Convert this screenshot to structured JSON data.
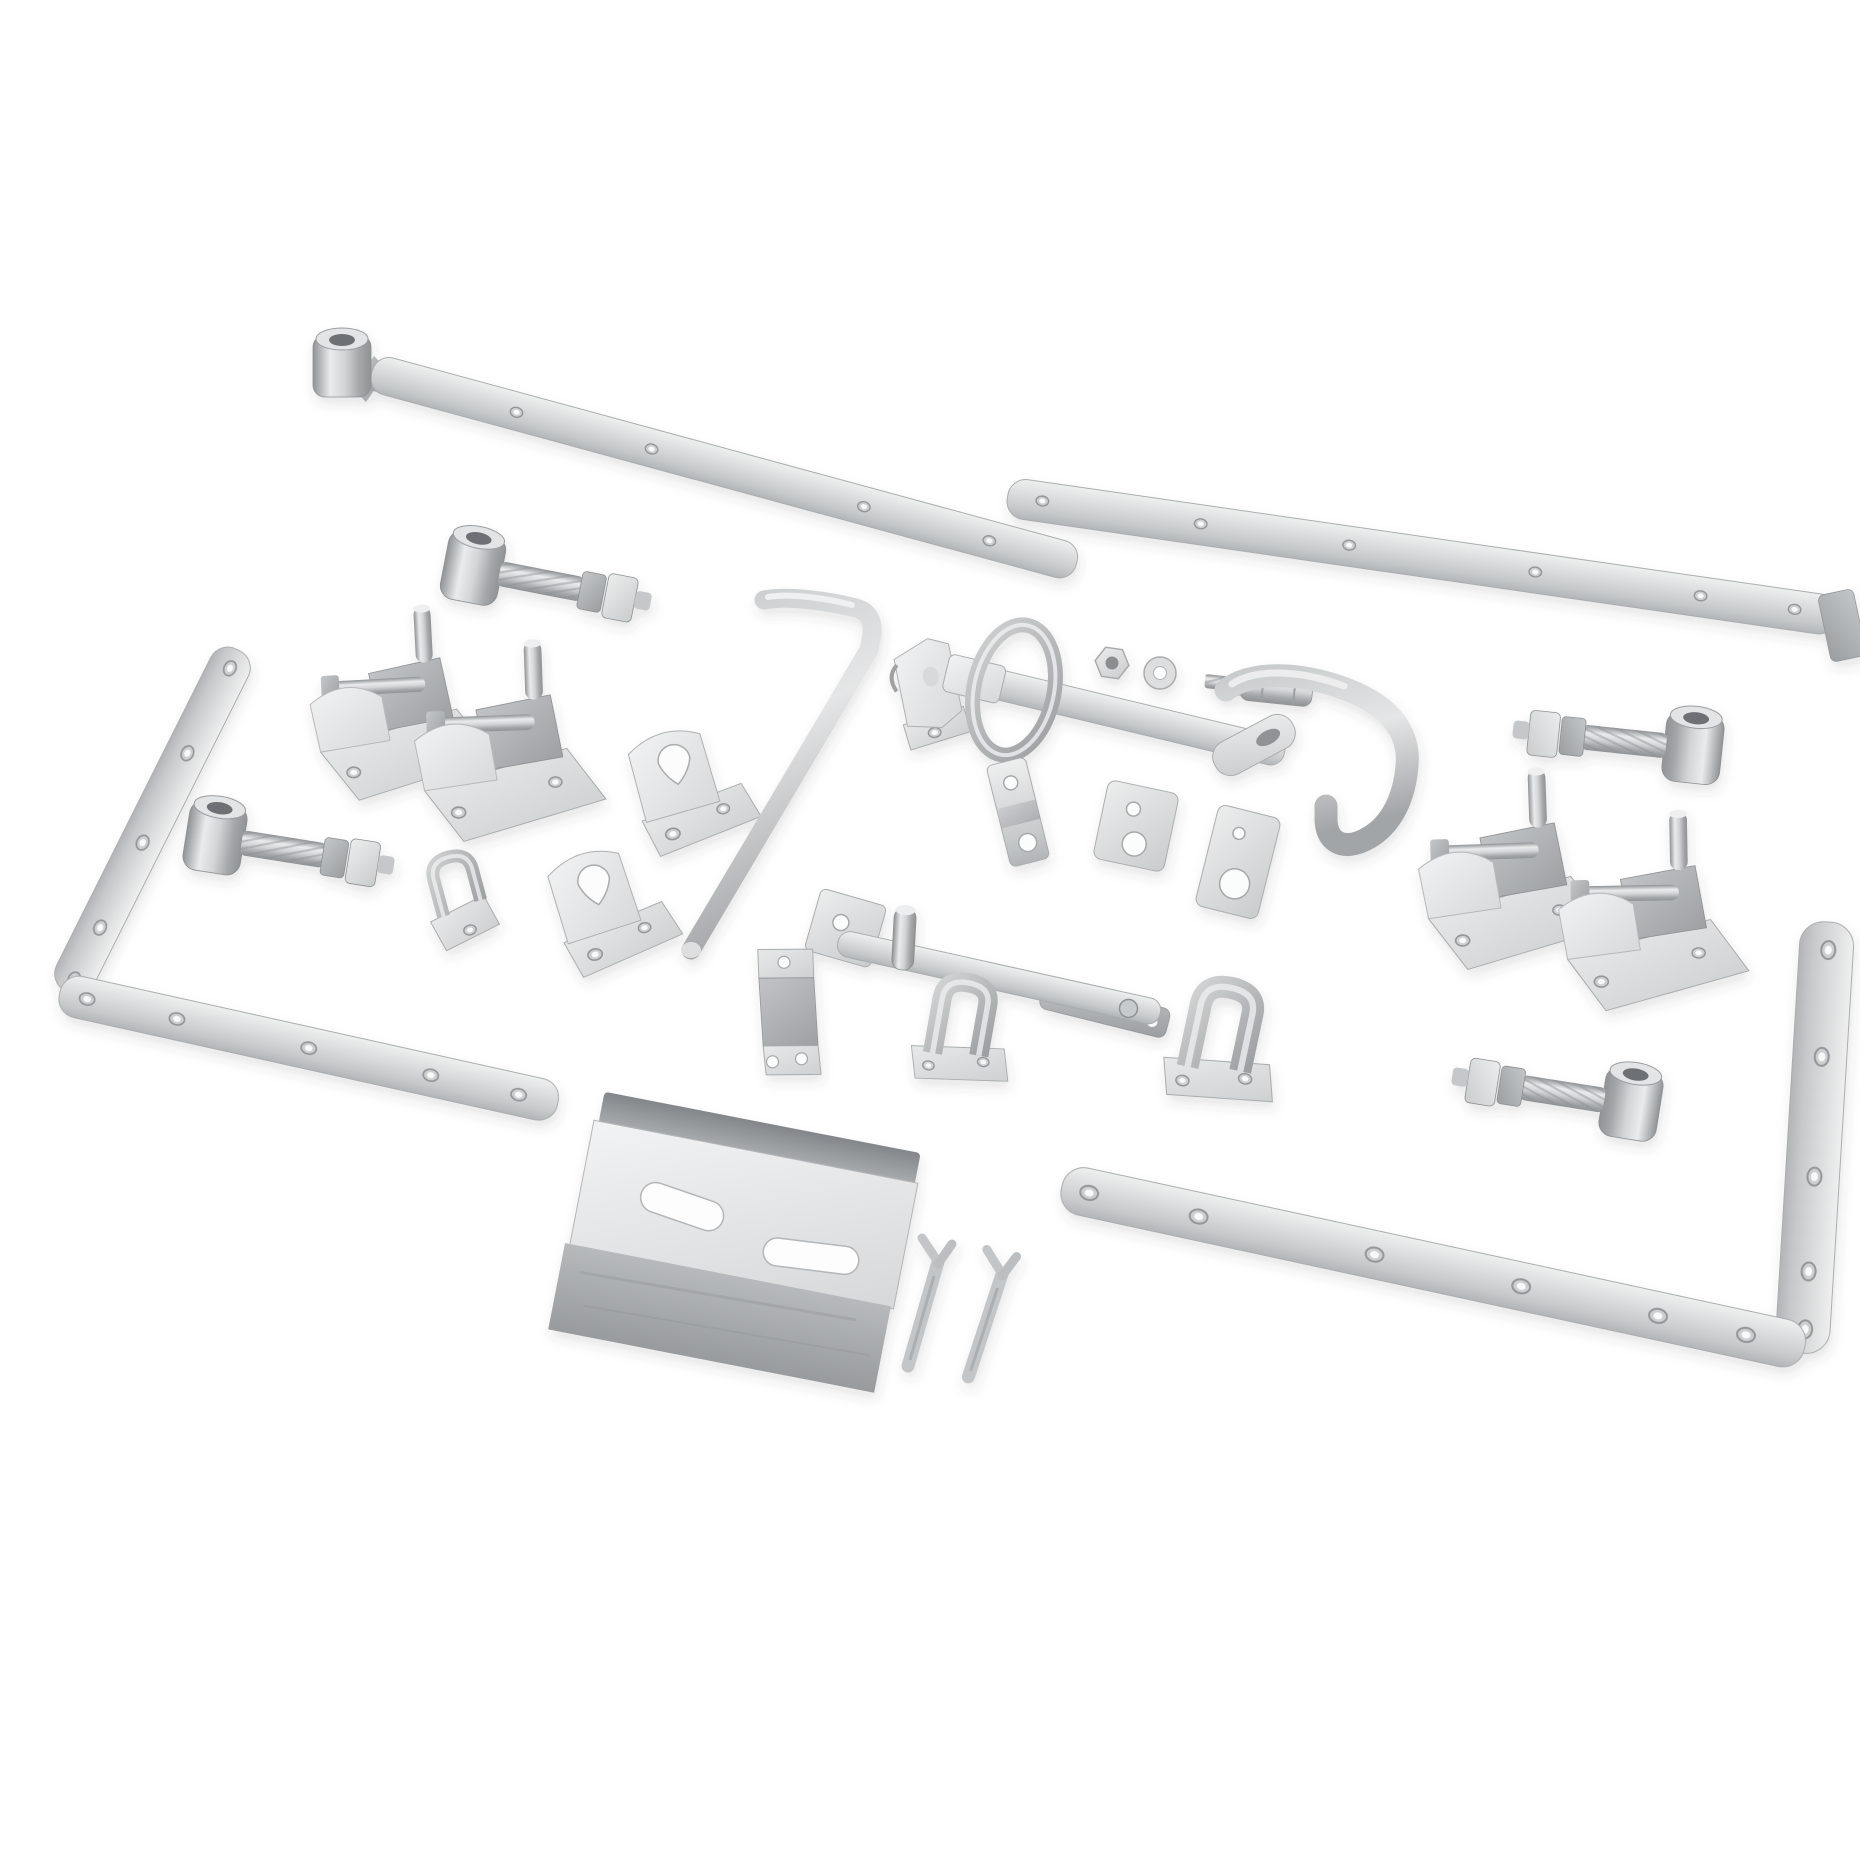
{
  "scene": {
    "type": "product-photo",
    "description": "Galvanised silver steel field-gate hardware kit: hinge bands, corner straps, adjustable shoe hinge brackets, eye bolts, latch bars, keeper plates, drop bolt rod, saddle clips, folded spring catch plate and split cotter pins laid out on a plain white background",
    "background": "#ffffff"
  },
  "palette": {
    "background": "#ffffff",
    "metal_light": "#eceeee",
    "metal_mid": "#d2d4d5",
    "metal_dark": "#a9acae",
    "metal_edge": "#a6a9ab",
    "hole_rim": "#94979a",
    "bore_dark": "#6d7174",
    "shadow": "rgba(60,64,66,0.14)"
  },
  "parts": [
    {
      "id": "hinge-band-top-left",
      "label": "Hook and band hinge strap with welded pivot eye"
    },
    {
      "id": "hinge-band-top-right",
      "label": "Hinge band strap with cranked end"
    },
    {
      "id": "corner-strap-left",
      "label": "L-shaped corner hinge strap with screw holes"
    },
    {
      "id": "corner-strap-right",
      "label": "L-shaped corner hinge strap with screw holes"
    },
    {
      "id": "shoe-bracket-1",
      "label": "Adjustable shoe hinge bracket with vertical pin"
    },
    {
      "id": "shoe-bracket-2",
      "label": "Adjustable shoe hinge bracket with vertical pin"
    },
    {
      "id": "shoe-bracket-3",
      "label": "Adjustable shoe hinge bracket with vertical pin"
    },
    {
      "id": "shoe-bracket-4",
      "label": "Adjustable shoe hinge bracket with vertical pin"
    },
    {
      "id": "eye-bolt-1",
      "label": "Adjustable hinge eye bolt with two lock nuts"
    },
    {
      "id": "eye-bolt-2",
      "label": "Adjustable hinge eye bolt with two lock nuts"
    },
    {
      "id": "eye-bolt-3",
      "label": "Adjustable hinge eye bolt with two lock nuts"
    },
    {
      "id": "eye-bolt-4",
      "label": "Adjustable hinge eye bolt with two lock nuts"
    },
    {
      "id": "hook-keeper-plate",
      "label": "Hook keeper on back plate"
    },
    {
      "id": "teardrop-bracket-1",
      "label": "Angle guide bracket with teardrop slot"
    },
    {
      "id": "teardrop-bracket-2",
      "label": "Angle guide bracket with teardrop slot"
    },
    {
      "id": "drop-bolt-rod",
      "label": "Cranked gate drop bolt rod"
    },
    {
      "id": "cleat-bracket",
      "label": "Angled cleat bracket with base hole"
    },
    {
      "id": "ring-latch-bar",
      "label": "Ring handle latch bar with slotted end"
    },
    {
      "id": "hex-nut",
      "label": "Hex nut"
    },
    {
      "id": "washer",
      "label": "Flat washer"
    },
    {
      "id": "hinge-pin",
      "label": "Stepped hinge gudgeon pin"
    },
    {
      "id": "catch-handle",
      "label": "Bent round-bar catch handle"
    },
    {
      "id": "eye-tab",
      "label": "Slotted eye tab"
    },
    {
      "id": "cranked-keeper",
      "label": "Cranked keeper plate with holes"
    },
    {
      "id": "twin-hole-plate",
      "label": "Back plate with two holes"
    },
    {
      "id": "catch-hole-plate",
      "label": "Catch plate with round hole"
    },
    {
      "id": "slide-latch",
      "label": "Slide latch bar with pin, pivot rivet and keeper"
    },
    {
      "id": "saddle-clip-1",
      "label": "Saddle clip on base plate"
    },
    {
      "id": "saddle-clip-2",
      "label": "Saddle clip on base plate"
    },
    {
      "id": "z-bracket",
      "label": "Z-cranked keeper bracket"
    },
    {
      "id": "spring-catch-plate",
      "label": "Folded spring catch plate with slotted face"
    },
    {
      "id": "cotter-pin-1",
      "label": "Split Y cotter pin"
    },
    {
      "id": "cotter-pin-2",
      "label": "Split Y cotter pin"
    }
  ]
}
